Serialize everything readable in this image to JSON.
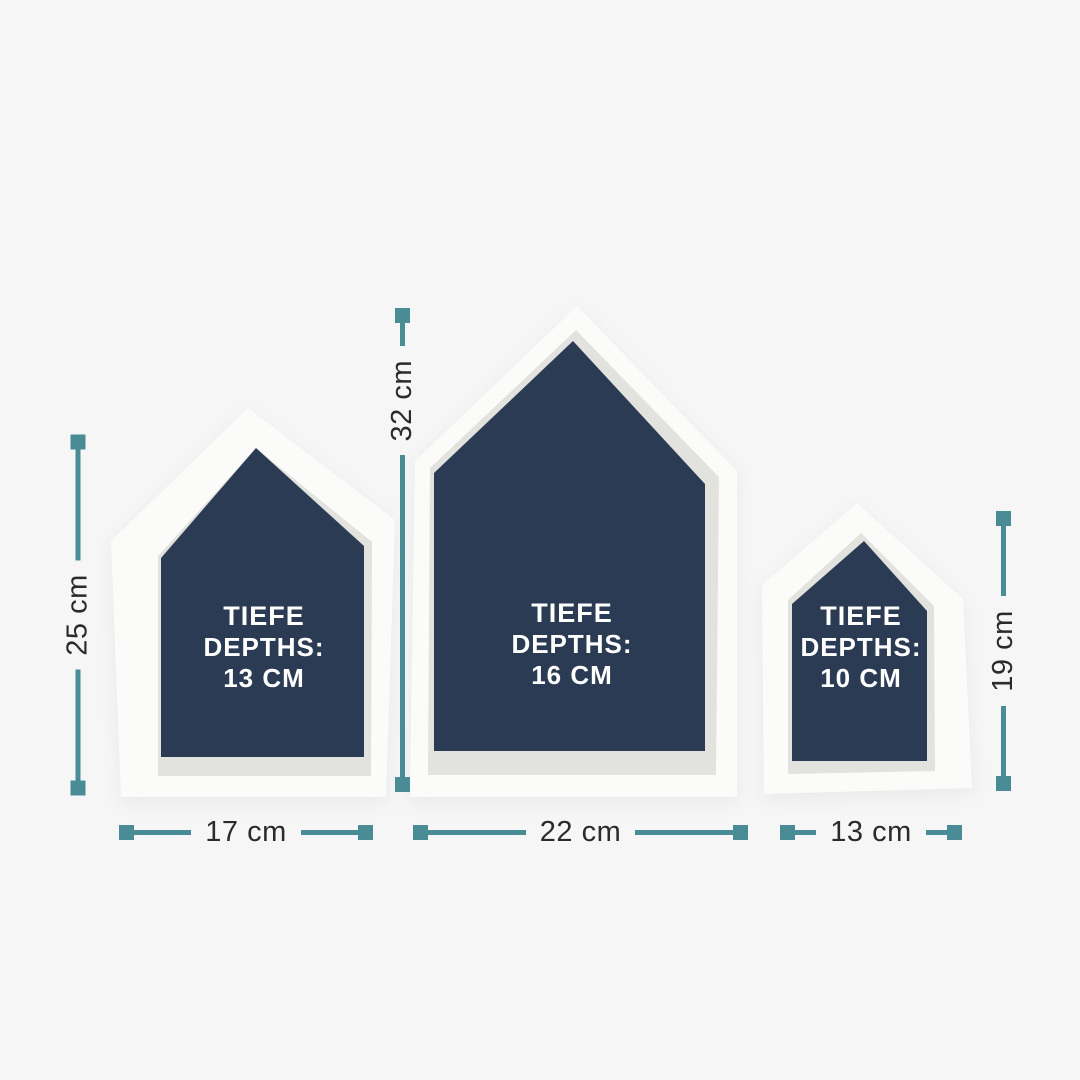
{
  "colors": {
    "background": "#f6f6f6",
    "teal": "#4a8c96",
    "navy": "#2c3b54",
    "frame": "#fbfbf9",
    "bevel": "#e2e2de",
    "dimtext": "#2b2b2b",
    "labeltext": "#ffffff"
  },
  "shelves": {
    "left": {
      "depth_title": "TIEFE",
      "depth_word": "DEPTHS:",
      "depth_value": "13 CM",
      "height": "25 cm",
      "width": "17 cm"
    },
    "middle": {
      "depth_title": "TIEFE",
      "depth_word": "DEPTHS:",
      "depth_value": "16 CM",
      "height": "32 cm",
      "width": "22 cm"
    },
    "right": {
      "depth_title": "TIEFE",
      "depth_word": "DEPTHS:",
      "depth_value": "10 CM",
      "height": "19 cm",
      "width": "13 cm"
    }
  }
}
